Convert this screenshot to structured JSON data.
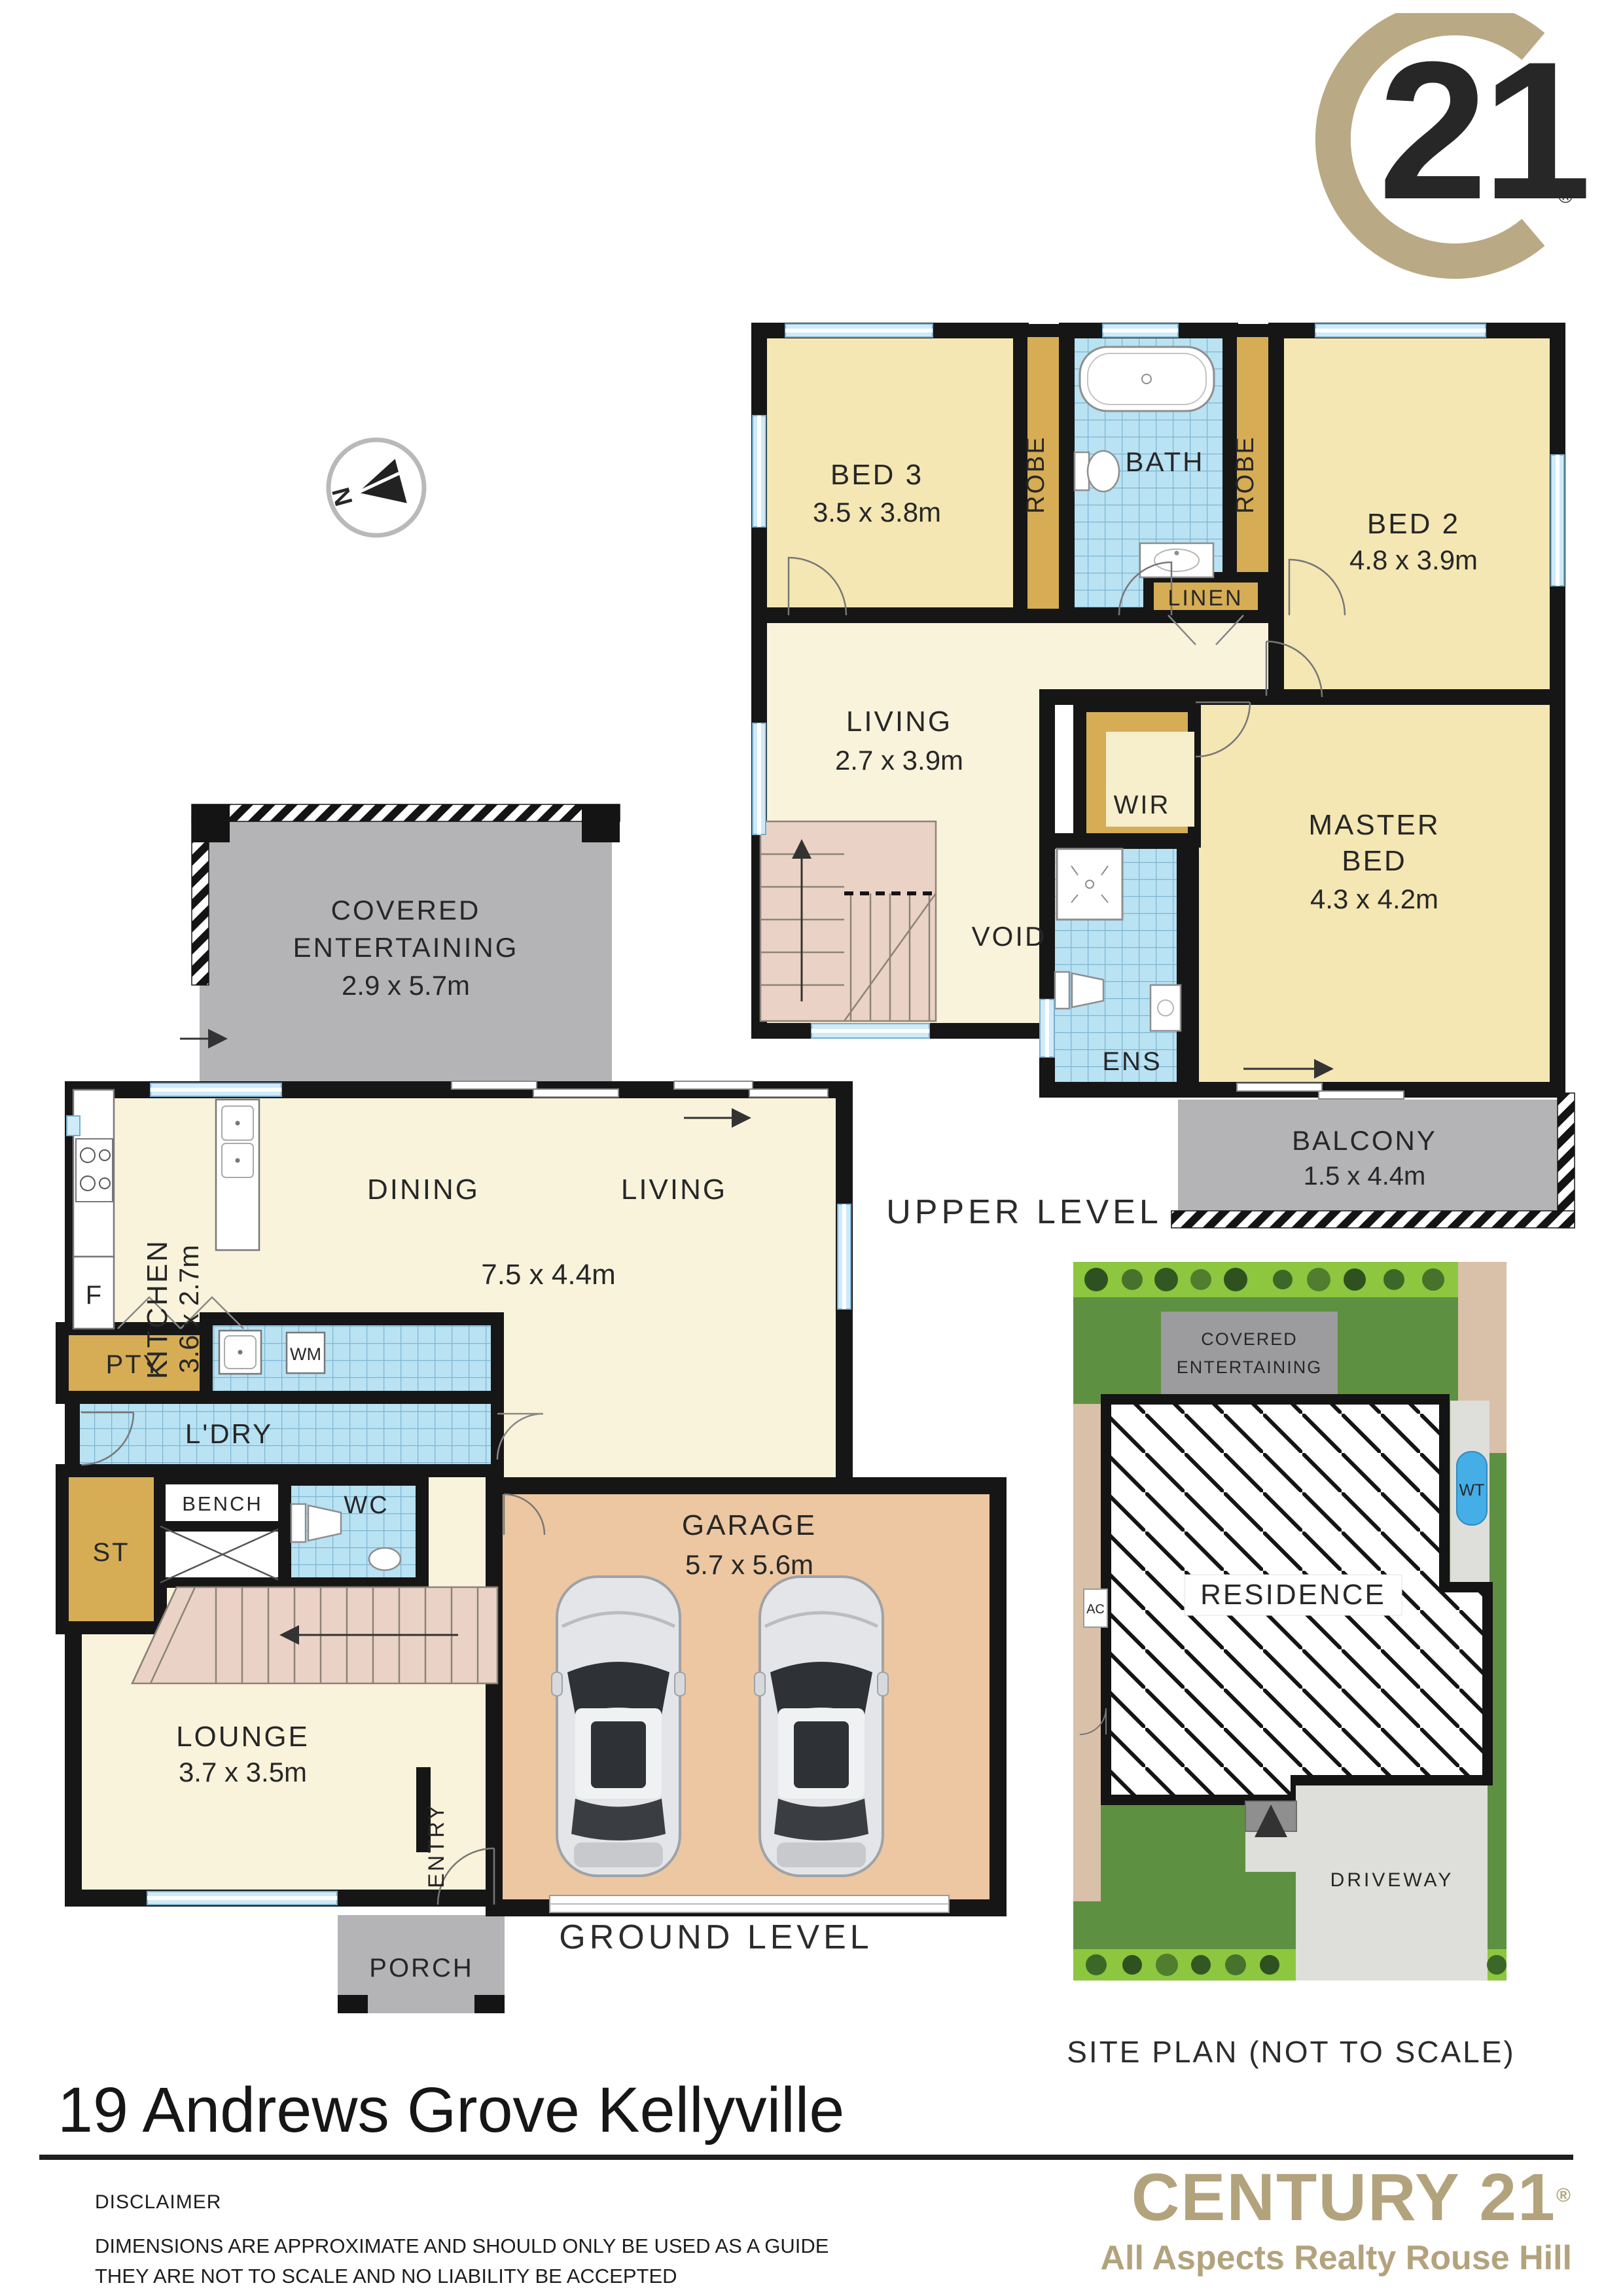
{
  "address": "19 Andrews Grove Kellyville",
  "disclaimer": {
    "heading": "DISCLAIMER",
    "line1": "DIMENSIONS ARE APPROXIMATE AND SHOULD ONLY BE USED AS A GUIDE",
    "line2": "THEY ARE NOT TO SCALE AND NO LIABILITY BE ACCEPTED"
  },
  "brand": {
    "logo_number": "21",
    "registered": "®",
    "name": "CENTURY 21",
    "office": "All Aspects Realty Rouse Hill"
  },
  "north": "N",
  "captions": {
    "upper": "UPPER LEVEL",
    "ground": "GROUND LEVEL",
    "site": "SITE PLAN (NOT TO SCALE)"
  },
  "upper": {
    "bed3": "BED 3",
    "bed3_dim": "3.5 x 3.8m",
    "robe": "ROBE",
    "bath": "BATH",
    "bed2": "BED 2",
    "bed2_dim": "4.8 x 3.9m",
    "linen": "LINEN",
    "living": "LIVING",
    "living_dim": "2.7 x 3.9m",
    "wir": "WIR",
    "void": "VOID",
    "ens": "ENS",
    "master_l1": "MASTER",
    "master_l2": "BED",
    "master_dim": "4.3 x 4.2m",
    "balcony": "BALCONY",
    "balcony_dim": "1.5 x 4.4m"
  },
  "ground": {
    "covered_l1": "COVERED",
    "covered_l2": "ENTERTAINING",
    "covered_dim": "2.9 x 5.7m",
    "kitchen": "KITCHEN",
    "kitchen_dim": "3.6 x 2.7m",
    "dining": "DINING",
    "living": "LIVING",
    "living_dim": "7.5 x 4.4m",
    "fridge": "F",
    "pantry": "PTY",
    "wm": "WM",
    "laundry": "L'DRY",
    "bench": "BENCH",
    "store": "ST",
    "wc": "WC",
    "lounge": "LOUNGE",
    "lounge_dim": "3.7 x 3.5m",
    "entry": "ENTRY",
    "porch": "PORCH",
    "garage": "GARAGE",
    "garage_dim": "5.7 x 5.6m"
  },
  "site": {
    "covered_l1": "COVERED",
    "covered_l2": "ENTERTAINING",
    "residence": "RESIDENCE",
    "driveway": "DRIVEWAY",
    "wt": "WT",
    "ac": "AC"
  },
  "colors": {
    "brand_gold": "#b3a37d",
    "logo_gold": "#b9aa85",
    "wall_black": "#161616",
    "room_yellow": "#f4e7b3",
    "room_cream": "#faf3dc",
    "wardrobe_gold": "#d6ad55",
    "tile_blue": "#b9e2f3",
    "garage_tan": "#ecc7a1",
    "outdoor_grey": "#b4b4b6",
    "stair_pink": "#ead3c6",
    "site_green_dark": "#5d9141",
    "site_green_light": "#8dc63f",
    "driveway_grey": "#dededa",
    "soil_tan": "#d9c0a8",
    "water_tank_blue": "#45aee6",
    "window_blue": "#cfeaf9"
  }
}
